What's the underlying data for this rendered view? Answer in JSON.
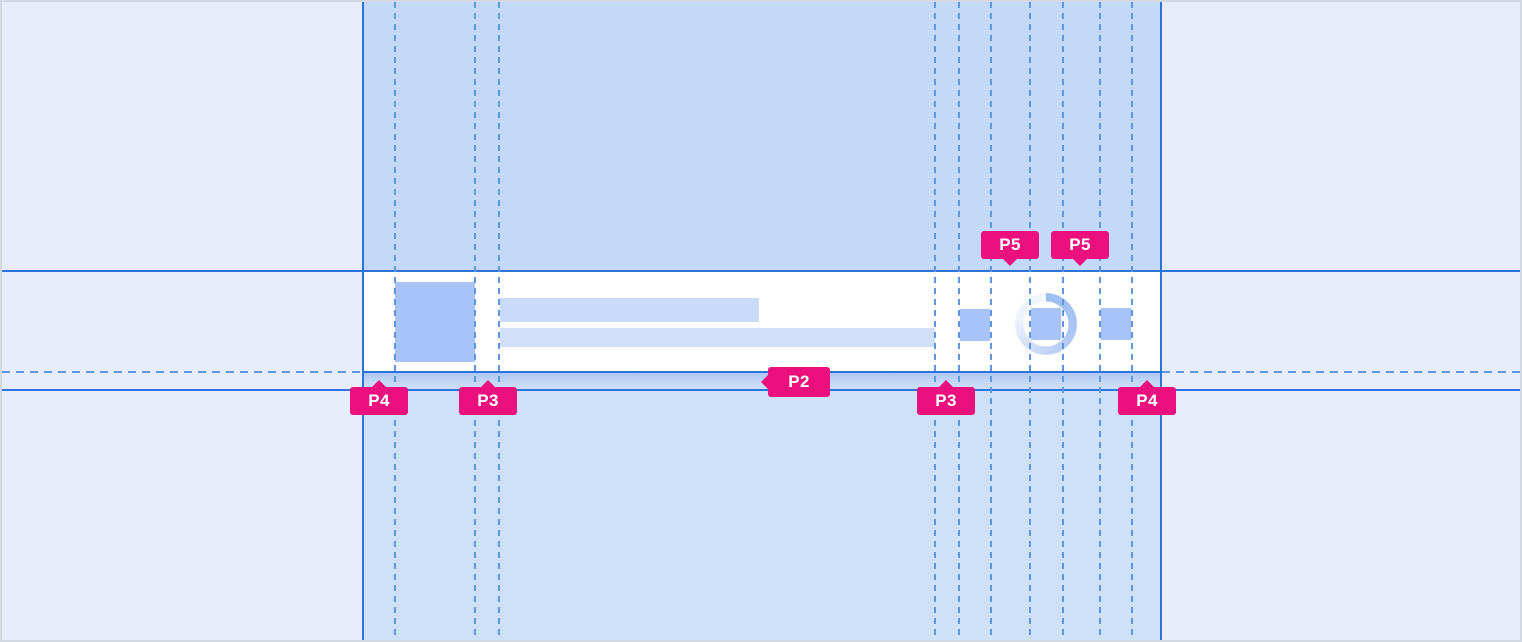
{
  "canvas": {
    "width": 1522,
    "height": 642
  },
  "colors": {
    "annotation_pink": "#EC0F7E",
    "guide_solid_blue": "#2B73DE",
    "guide_dashed_blue": "#5E96E0",
    "column_band_top": "#C4D9F8",
    "column_band_bottom": "#CFE0F9",
    "margin_background": "#E8EDFB",
    "row_background": "#FFFFFF",
    "placeholder_strong": "#A8C3F7",
    "placeholder_title": "#C9DBF8",
    "placeholder_subtitle": "#D1E0F9"
  },
  "annotations": {
    "labels": [
      {
        "id": "p4-left",
        "text": "P4",
        "pointer": "up"
      },
      {
        "id": "p3-left",
        "text": "P3",
        "pointer": "up"
      },
      {
        "id": "p2",
        "text": "P2",
        "pointer": "left"
      },
      {
        "id": "p3-right",
        "text": "P3",
        "pointer": "up"
      },
      {
        "id": "p4-right",
        "text": "P4",
        "pointer": "up"
      },
      {
        "id": "p5-left",
        "text": "P5",
        "pointer": "down"
      },
      {
        "id": "p5-right",
        "text": "P5",
        "pointer": "down"
      }
    ]
  }
}
